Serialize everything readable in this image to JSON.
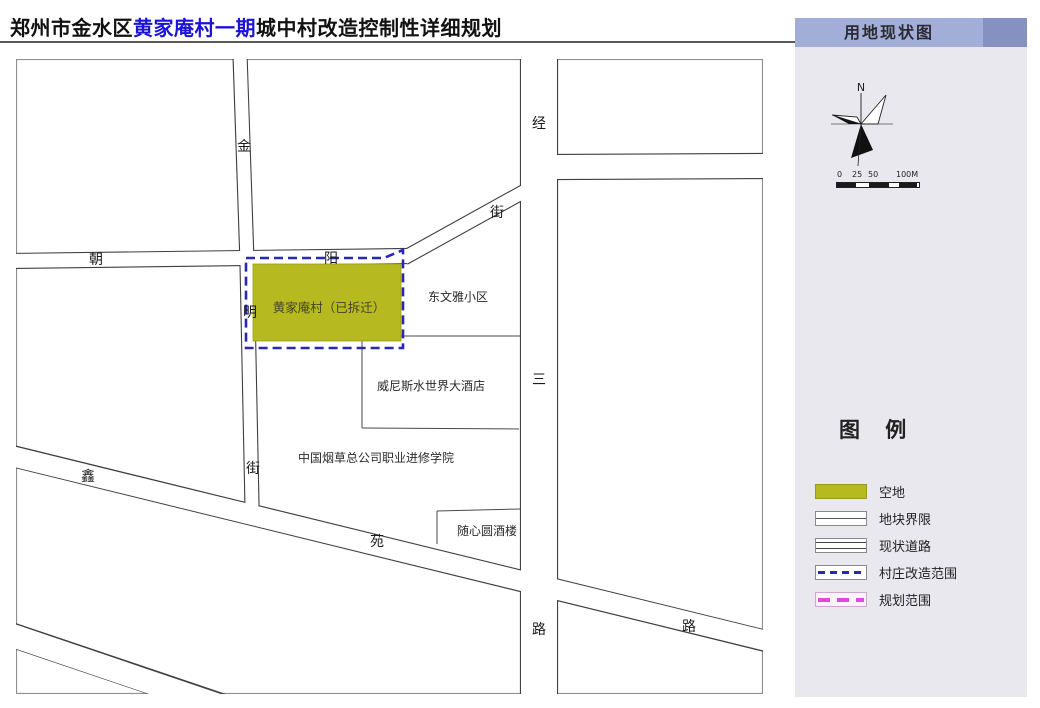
{
  "title": {
    "black_prefix": "郑州市金水区",
    "blue_highlight": "黄家庵村一期",
    "black_suffix": "城中村改造控制性详细规划"
  },
  "panel": {
    "header": "用地现状图",
    "compass_n": "N",
    "scale_ticks": [
      "0",
      "25",
      "50",
      "100M"
    ],
    "legend_title": "图 例",
    "legend": [
      {
        "label": "空地",
        "symbol": "vacant-land-fill"
      },
      {
        "label": "地块界限",
        "symbol": "plot-boundary-line"
      },
      {
        "label": "现状道路",
        "symbol": "existing-road-lines"
      },
      {
        "label": "村庄改造范围",
        "symbol": "blue-dashed-line"
      },
      {
        "label": "规划范围",
        "symbol": "magenta-dashed-line"
      }
    ]
  },
  "map": {
    "village_parcel_label": "黄家庵村（已拆迁）",
    "areas": {
      "dongwenya": "东文雅小区",
      "venice_hotel": "威尼斯水世界大酒店",
      "tobacco_college": "中国烟草总公司职业进修学院",
      "suixinyuan_restaurant": "随心圆酒楼"
    },
    "roads": {
      "jinming_street": [
        "金",
        "明",
        "街"
      ],
      "chaoyang_street": [
        "朝",
        "阳",
        "街"
      ],
      "jingsan_road": [
        "经",
        "三",
        "路"
      ],
      "xinyuan_road": [
        "鑫",
        "苑",
        "路"
      ]
    }
  },
  "colors": {
    "vacant_land_fill": "#b6b91f",
    "village_boundary_dash": "#2828b4",
    "planning_boundary_dash": "#d94ed9",
    "panel_bg": "#e9e8ee",
    "panel_header_bg": "#a3aed8",
    "panel_header_accent": "#8691c1",
    "title_highlight": "#1b13d6"
  }
}
